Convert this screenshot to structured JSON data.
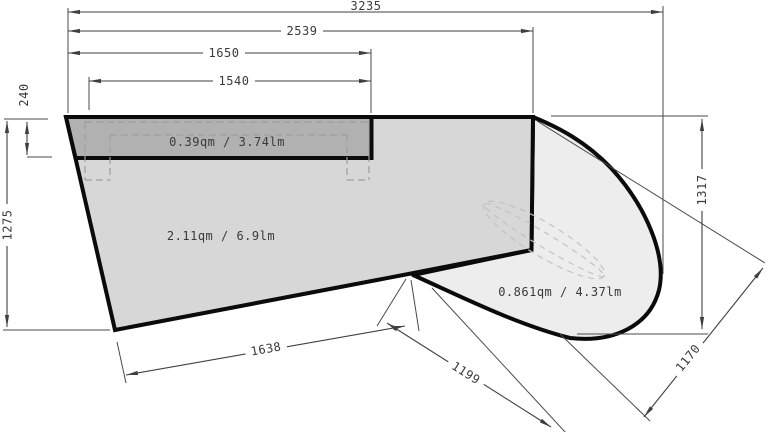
{
  "dimensions": {
    "d3235": "3235",
    "d2539": "2539",
    "d1650": "1650",
    "d1540": "1540",
    "d240": "240",
    "d1275": "1275",
    "d1317": "1317",
    "d1638": "1638",
    "d1199": "1199",
    "d1170": "1170"
  },
  "areas": {
    "top_strip": "0.39qm / 3.74lm",
    "main": "2.11qm / 6.9lm",
    "right_curve": "0.861qm / 4.37lm"
  },
  "colors": {
    "main_fill": "#d7d7d7",
    "strip_fill": "#b1b1b1",
    "curve_fill": "#ededed",
    "outline": "#0b0b0b",
    "dim_line": "#3f3f3f",
    "dashed_gray": "#9e9e9e",
    "text": "#3a3a3a"
  }
}
